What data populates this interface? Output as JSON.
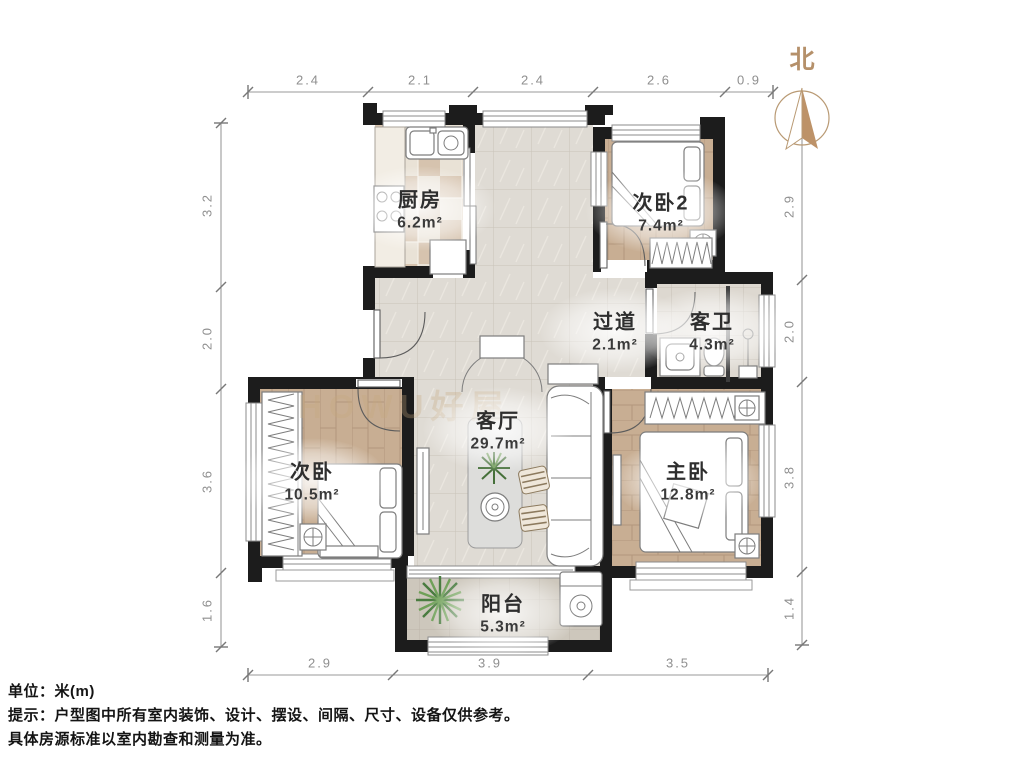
{
  "compass": {
    "label": "北"
  },
  "rooms": {
    "kitchen": {
      "name": "厨房",
      "area": "6.2m²"
    },
    "bedroom2": {
      "name": "次卧2",
      "area": "7.4m²"
    },
    "hallway": {
      "name": "过道",
      "area": "2.1m²"
    },
    "guest_bath": {
      "name": "客卫",
      "area": "4.3m²"
    },
    "living": {
      "name": "客厅",
      "area": "29.7m²"
    },
    "bedroom": {
      "name": "次卧",
      "area": "10.5m²"
    },
    "master": {
      "name": "主卧",
      "area": "12.8m²"
    },
    "balcony": {
      "name": "阳台",
      "area": "5.3m²"
    }
  },
  "dimensions": {
    "top": [
      "2.4",
      "2.1",
      "2.4",
      "2.6",
      "0.9"
    ],
    "bottom": [
      "2.9",
      "3.9",
      "3.5"
    ],
    "left": [
      "3.2",
      "2.0",
      "3.6",
      "1.6"
    ],
    "right": [
      "2.9",
      "2.0",
      "3.8",
      "1.4"
    ]
  },
  "footer": {
    "unit": "单位：米(m)",
    "tip1": "提示：户型图中所有室内装饰、设计、摆设、间隔、尺寸、设备仅供参考。",
    "tip2": "具体房源标准以室内勘查和测量为准。"
  },
  "watermark": "HOWU好屋",
  "colors": {
    "wall": "#1c1c1c",
    "wood": "#c8ae93",
    "tan": "#b5906a",
    "dim": "#8f8f8f",
    "label": "#2e2e2e",
    "watermark": "#c7a87e",
    "marble": "#dfdbd4"
  }
}
